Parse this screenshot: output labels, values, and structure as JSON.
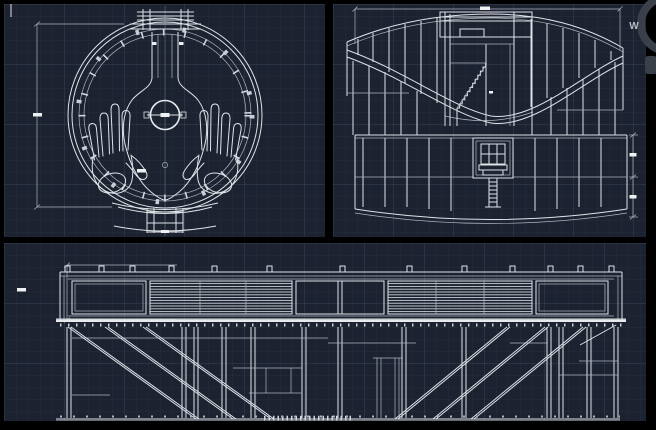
{
  "app": {
    "kind": "cad-drawing-canvas",
    "theme": "dark"
  },
  "colors": {
    "frame": "#000000",
    "viewport_background": "#1c2230",
    "grid_major": "rgba(125,150,190,0.10)",
    "grid_minor": "rgba(125,150,190,0.045)",
    "drawing_line": "#dfe3e8",
    "secondary_line": "#aeb5bf",
    "hatch_line": "#cdd2d8",
    "dimension_text_blob": "#eef0f3",
    "compass_ring": "#394049",
    "compass_text": "#b6bcc4"
  },
  "navigation": {
    "compass_label": "W"
  },
  "viewports": {
    "plan": {
      "name": "plan-view-circular-structure-with-hands"
    },
    "elevation": {
      "name": "elevation-view-bowl-with-staircase"
    },
    "section": {
      "name": "long-section-deck-and-hull-framing"
    }
  }
}
